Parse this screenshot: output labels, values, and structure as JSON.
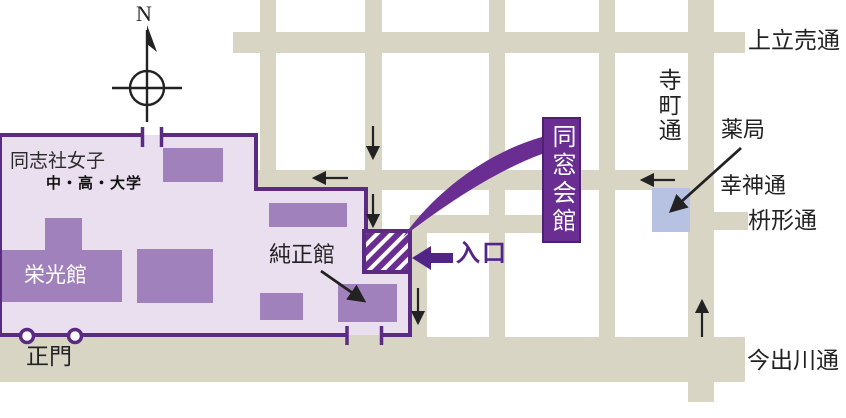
{
  "colors": {
    "street": "#d8d5c4",
    "campus_fill": "#eadfef",
    "campus_border": "#5b2b84",
    "building": "#a181bb",
    "banner_purple": "#6a2e92",
    "entrance_purple": "#512487",
    "pharmacy_blue": "#b7c2e2",
    "arrow_black": "#222222",
    "text_black": "#222222"
  },
  "compass": {
    "label": "N"
  },
  "streets": {
    "kamidachiuri": "上立売通",
    "teramachi": "寺町通",
    "koujin": "幸神通",
    "masugata": "枡形通",
    "imadegawa": "今出川通"
  },
  "campus": {
    "name": "同志社女子",
    "subtitle": "中・高・大学",
    "eikokan": "栄光館",
    "junseikan": "純正館",
    "seimon": "正門"
  },
  "poi": {
    "dousoukaikan": "同窓会館",
    "iriguchi": "入口",
    "yakkyoku": "薬局"
  }
}
